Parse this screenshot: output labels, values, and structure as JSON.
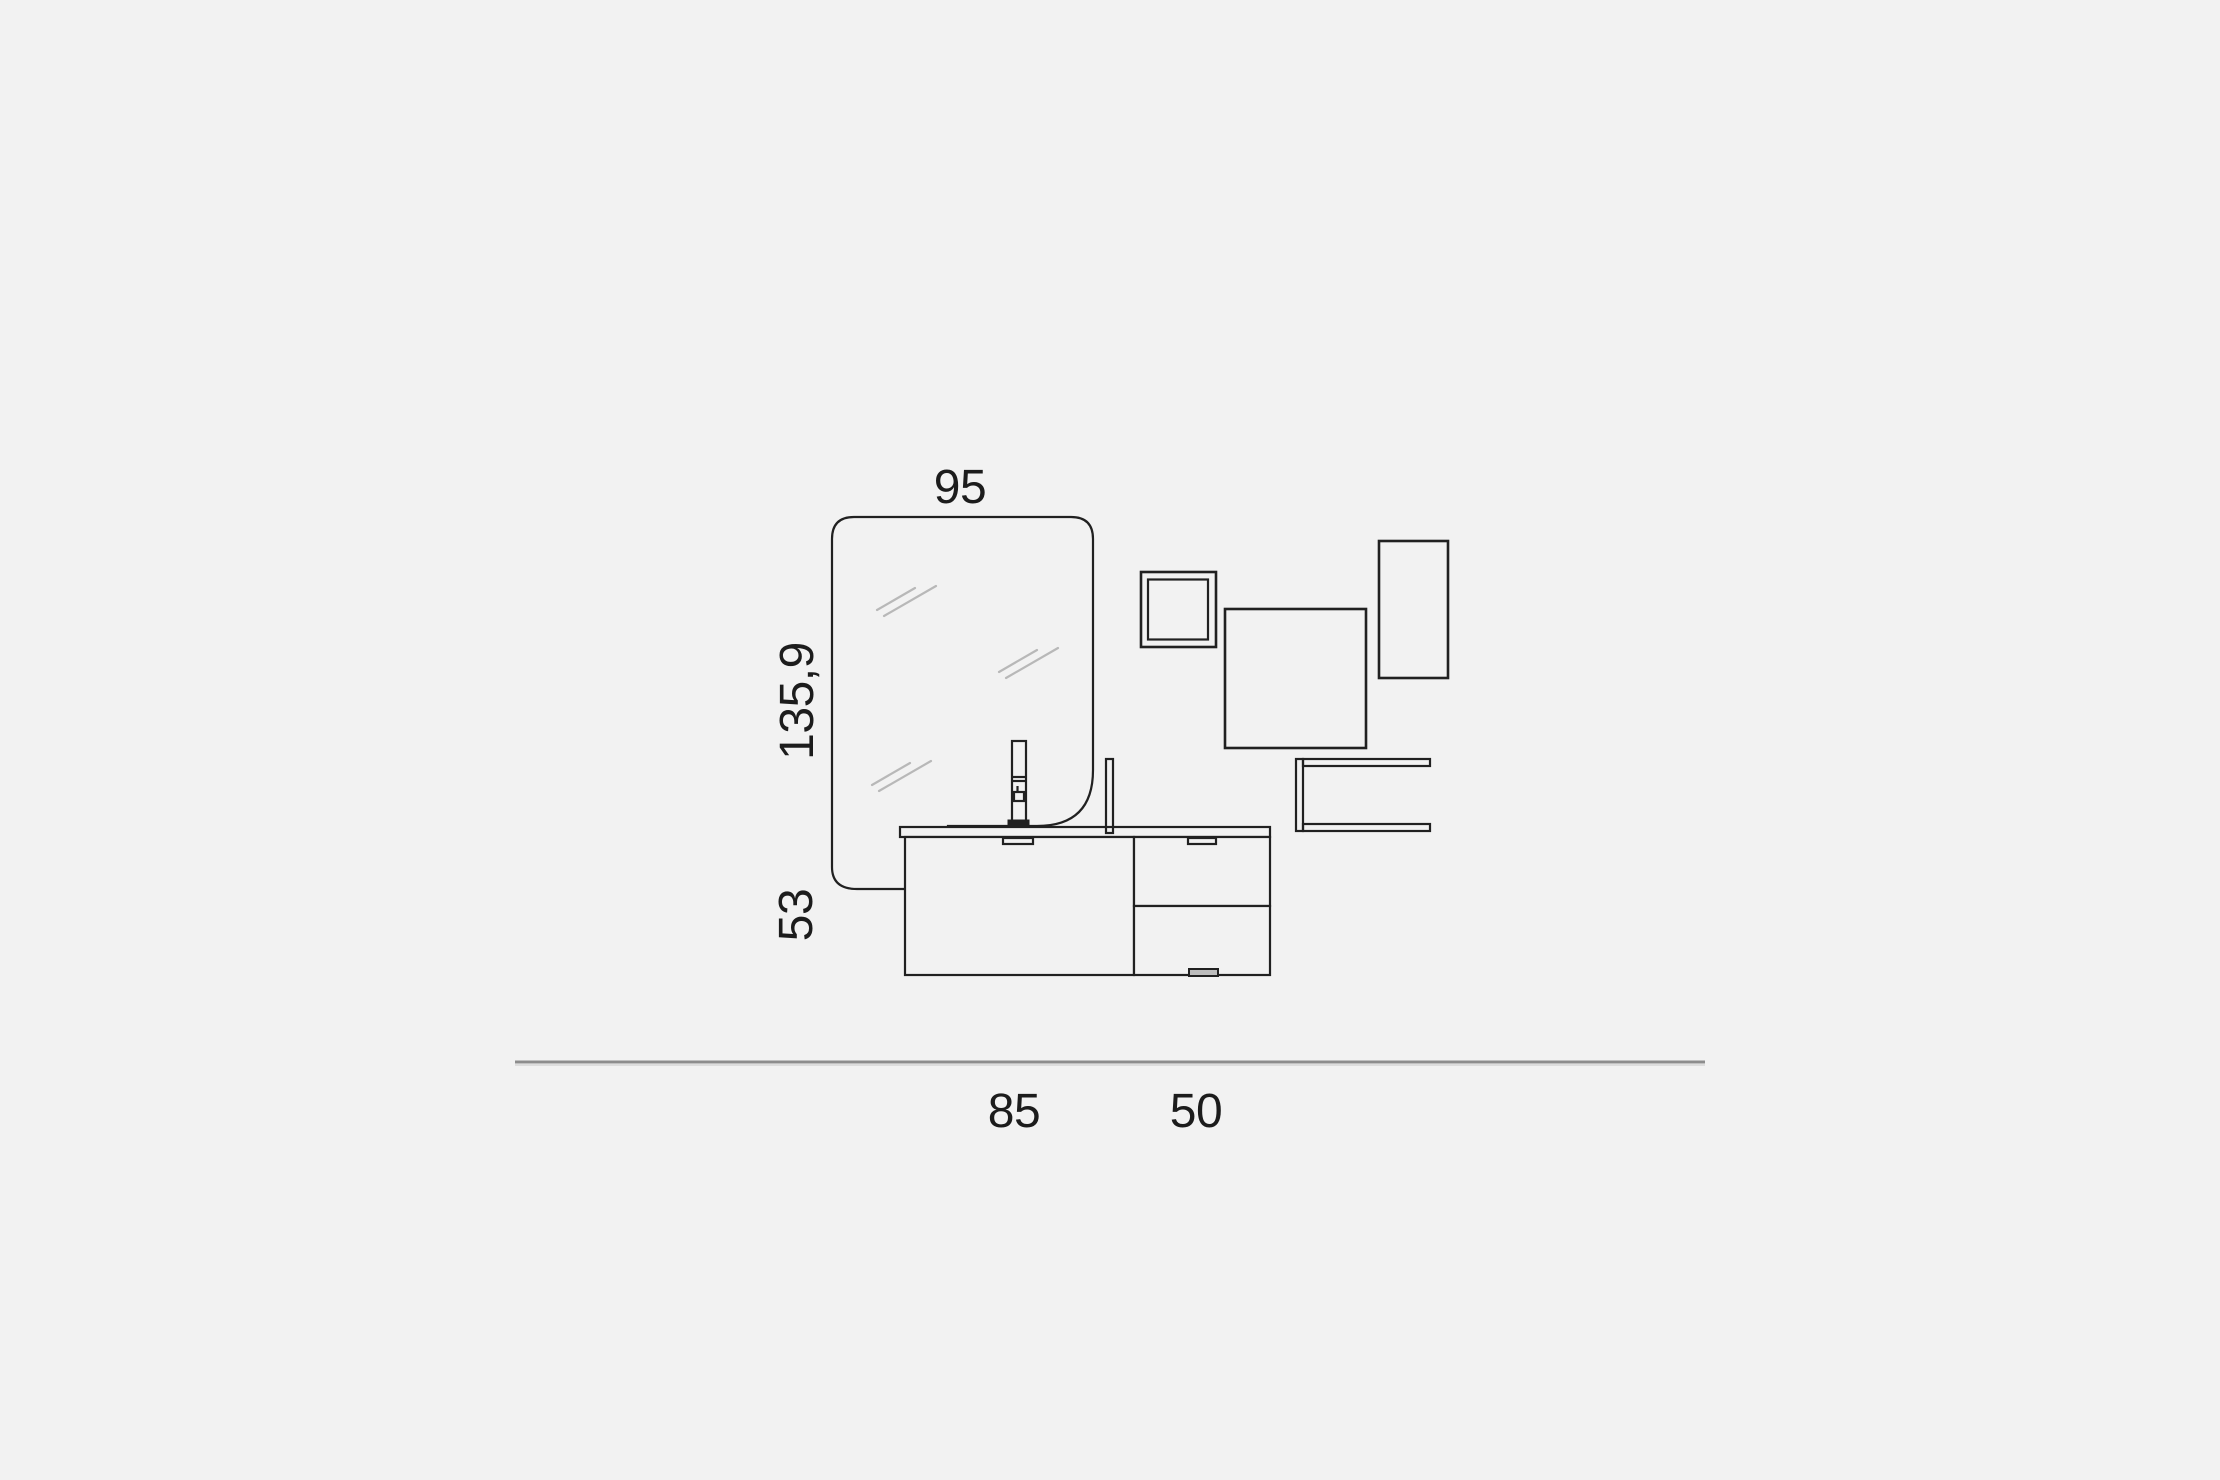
{
  "palette": {
    "background": "#f2f2f2",
    "line": "#212121",
    "reflection_line": "#b8b8b8",
    "floor_line": "#8d8d8d",
    "label_text": "#1c1c1c"
  },
  "labels": {
    "mirror_width": "95",
    "mirror_height": "135,9",
    "vanity_height": "53",
    "vanity_left_module_width": "85",
    "vanity_right_module_width": "50"
  }
}
